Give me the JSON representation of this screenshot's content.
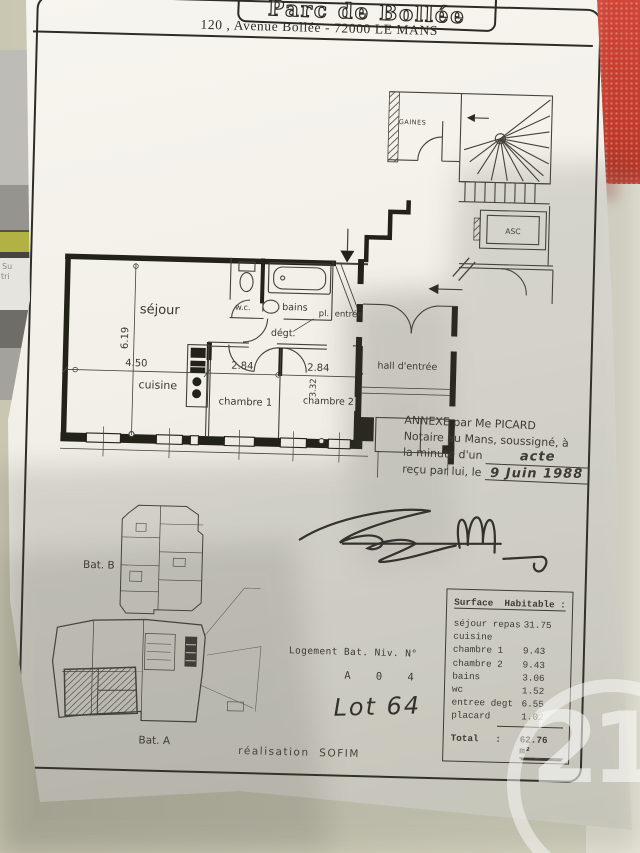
{
  "header": {
    "title": "Parc de Bollée",
    "address": "120 , Avenue Bollée - 72000 LE MANS"
  },
  "plan": {
    "labels": {
      "sejour": "séjour",
      "cuisine": "cuisine",
      "chambre1": "chambre 1",
      "chambre2": "chambre 2",
      "wc": "w.c.",
      "bains": "bains",
      "degagement": "dégt.",
      "placard": "pl.",
      "entree": "entrée",
      "hall": "hall d'entrée",
      "gaines": "GAINES",
      "asc": "ASC"
    },
    "dimensions": {
      "sejour_height": "6.19",
      "sejour_width": "4.50",
      "chambre1_width": "2.84",
      "chambre2_width": "2.84",
      "chambre2_height": "3.32"
    }
  },
  "notary": {
    "line1": "ANNEXE par Me PICARD",
    "line2": "Notaire au Mans, soussigné, à",
    "line3_printed": "la minute d'un ",
    "line3_hand": "acte",
    "line4_printed": "reçu par lui, le ",
    "line4_hand": "9 Juin 1988"
  },
  "site_plan": {
    "building_b": "Bat. B",
    "building_a": "Bat. A"
  },
  "logement": {
    "caption": "Logement Bat. Niv. N°",
    "values": "A    0    4",
    "lot_hand": "Lot 64"
  },
  "surface_table": {
    "title": "Surface  Habitable :",
    "rows": [
      {
        "label": "séjour repas",
        "value": "31.75"
      },
      {
        "label": "cuisine",
        "value": ""
      },
      {
        "label": "chambre 1",
        "value": "9.43"
      },
      {
        "label": "chambre 2",
        "value": "9.43"
      },
      {
        "label": "bains",
        "value": "3.06"
      },
      {
        "label": "wc",
        "value": "1.52"
      },
      {
        "label": "entree degt",
        "value": "6.55"
      },
      {
        "label": "placard",
        "value": "1.02"
      }
    ],
    "total_label": "Total   :",
    "total_value": "62.76 m²"
  },
  "footer": {
    "credit": "réalisation  SOFIM"
  },
  "watermark": {
    "text": "21"
  },
  "background_fragments": {
    "left_text_1": "Su",
    "left_text_2": "tri"
  }
}
